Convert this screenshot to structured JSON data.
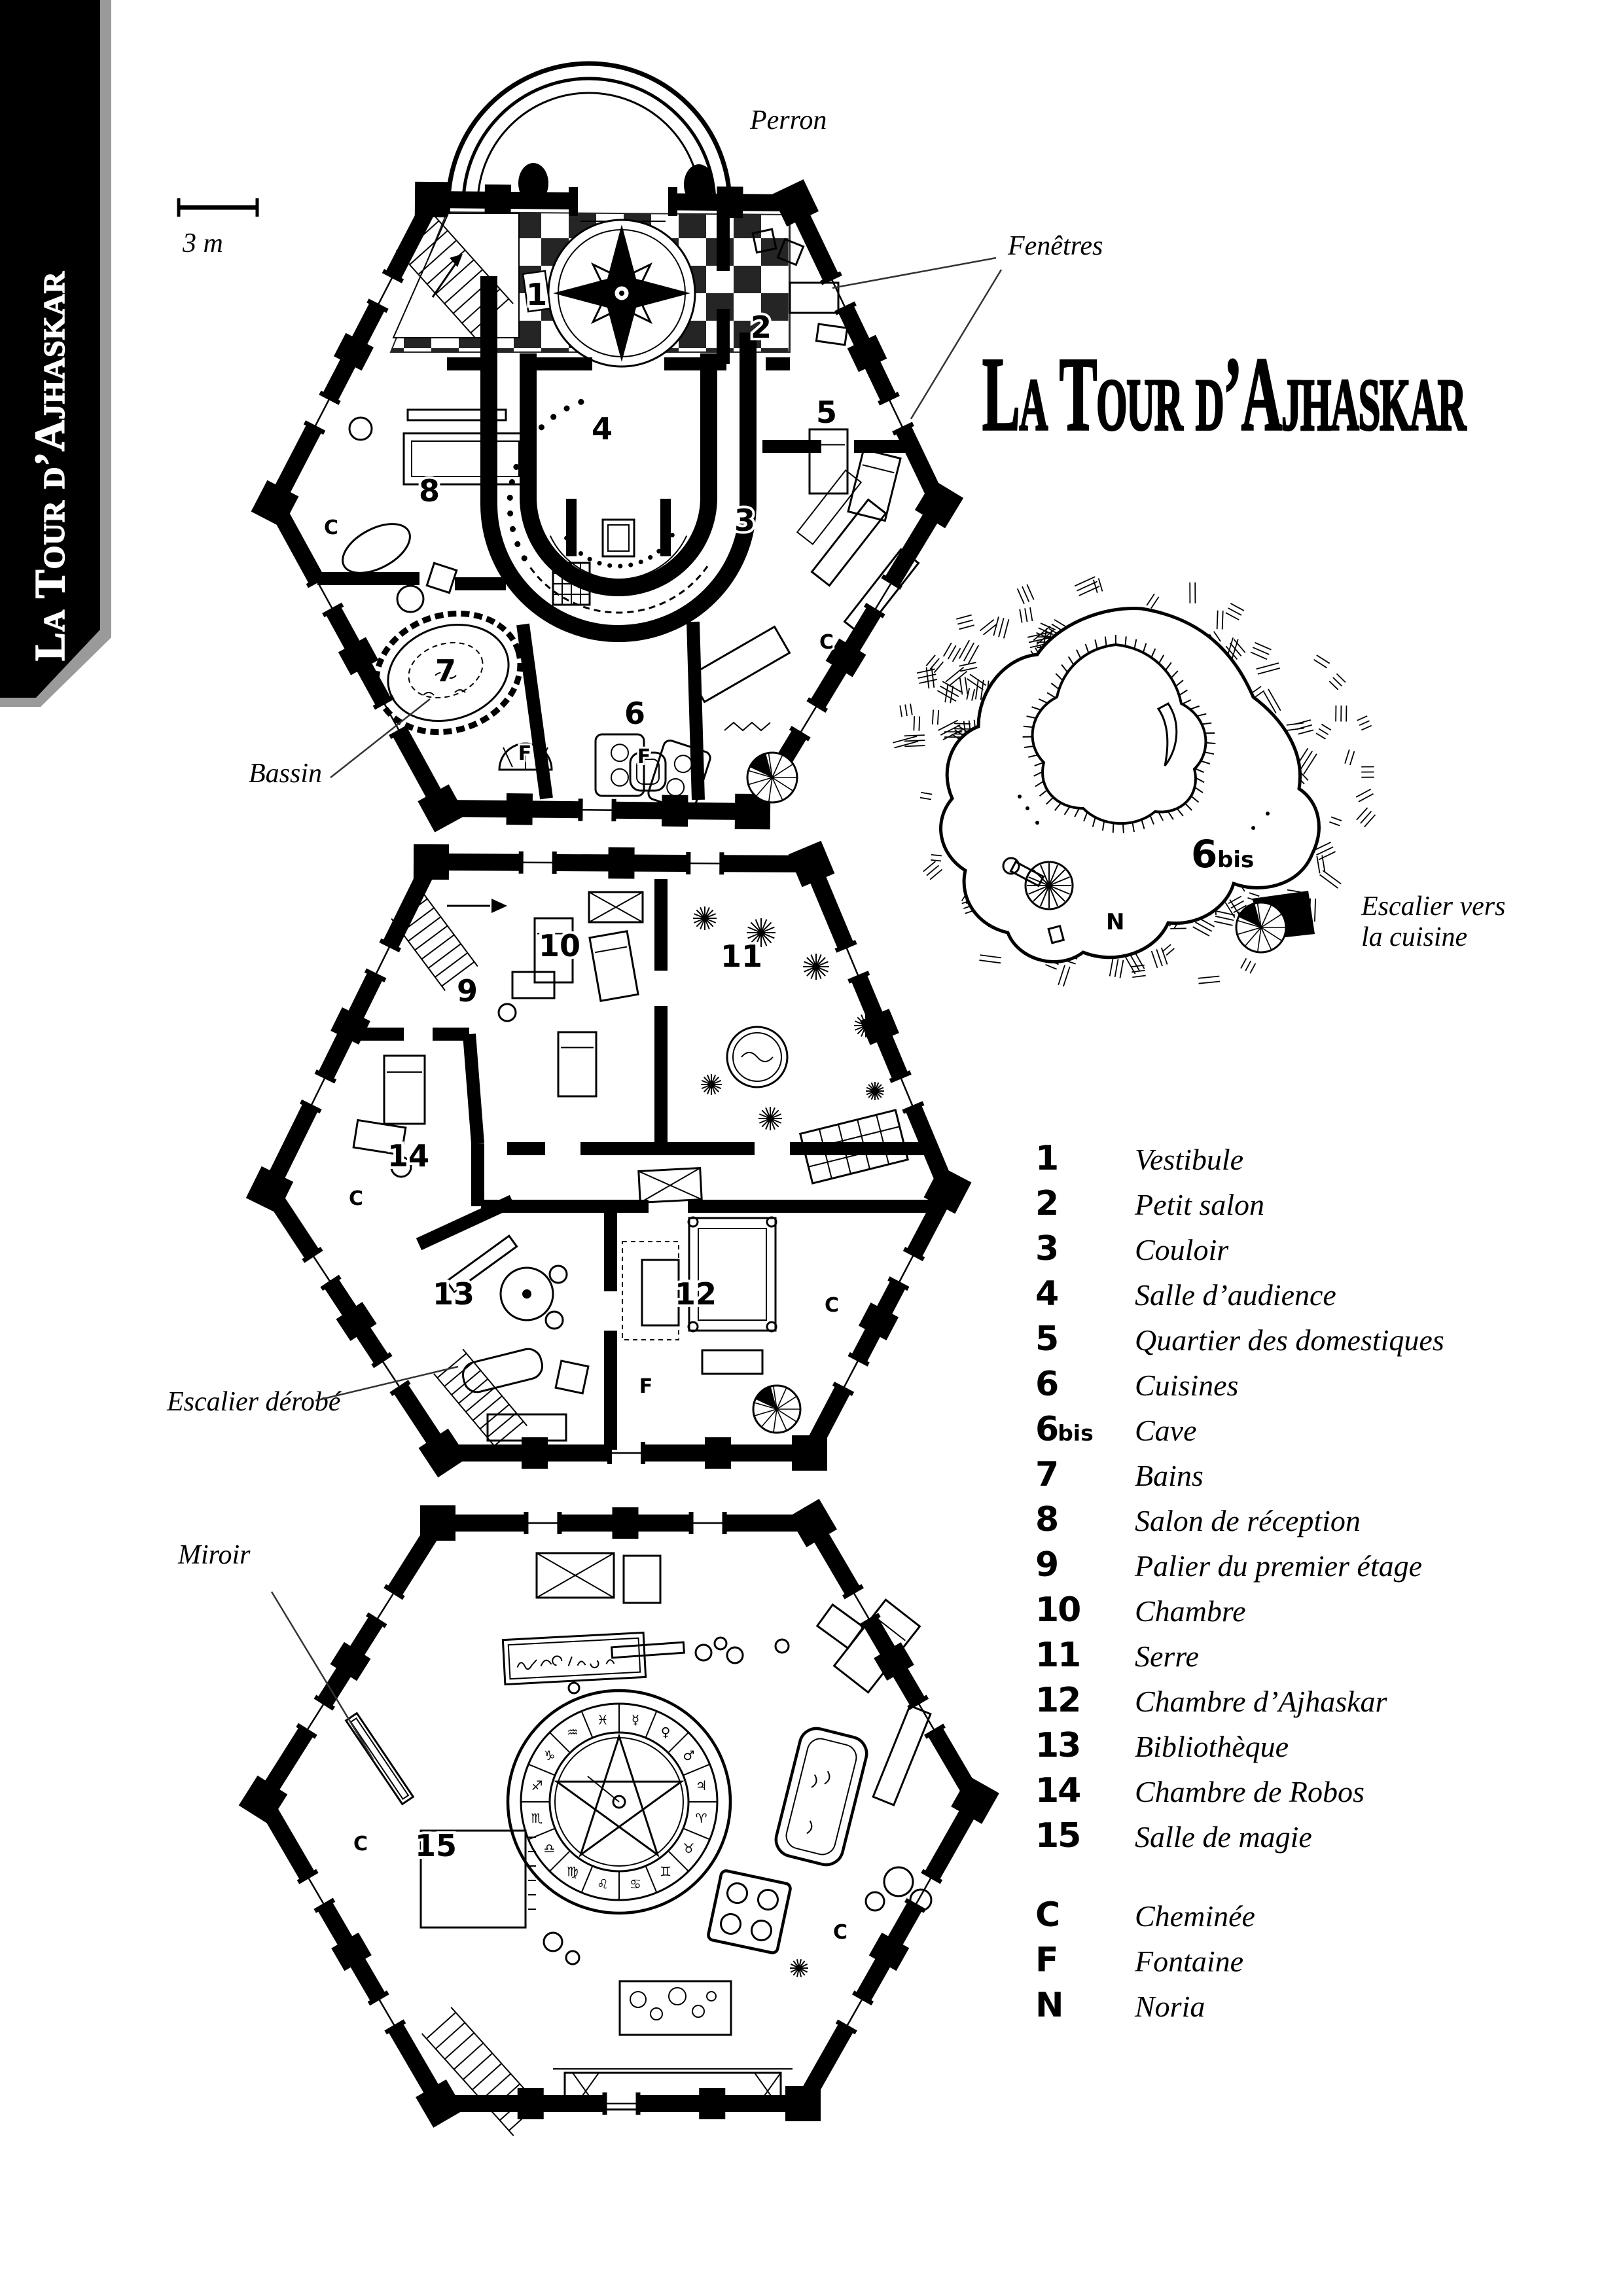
{
  "page": {
    "paper": "#ffffff",
    "ink": "#000000",
    "metal_gray": "#9a9a9a"
  },
  "sidebar": {
    "title": "La Tour d’Ajhaskar"
  },
  "header": {
    "title": "La Tour d’Ajhaskar"
  },
  "scale": {
    "label": "3 m"
  },
  "callouts": {
    "perron": "Perron",
    "fenetres": "Fenêtres",
    "bassin": "Bassin",
    "escalier_cuisine_1": "Escalier vers",
    "escalier_cuisine_2": "la cuisine",
    "escalier_derobe": "Escalier dérobé",
    "miroir": "Miroir"
  },
  "plans": {
    "ground": {
      "numbers": [
        "1",
        "2",
        "3",
        "4",
        "5",
        "6",
        "7",
        "8"
      ],
      "letters": [
        "C",
        "C",
        "F",
        "F"
      ]
    },
    "cave": {
      "number": "6",
      "suffix": "bis",
      "letter": "N"
    },
    "first": {
      "numbers": [
        "9",
        "10",
        "11",
        "12",
        "13",
        "14"
      ],
      "letters": [
        "C",
        "C",
        "F"
      ]
    },
    "second": {
      "numbers": [
        "15"
      ],
      "letters": [
        "C",
        "C"
      ]
    }
  },
  "legend": {
    "items": [
      {
        "num": "1",
        "label": "Vestibule"
      },
      {
        "num": "2",
        "label": "Petit salon"
      },
      {
        "num": "3",
        "label": "Couloir"
      },
      {
        "num": "4",
        "label": "Salle d’audience"
      },
      {
        "num": "5",
        "label": "Quartier des domestiques"
      },
      {
        "num": "6",
        "label": "Cuisines"
      },
      {
        "num": "6",
        "suffix": "bis",
        "label": "Cave"
      },
      {
        "num": "7",
        "label": "Bains"
      },
      {
        "num": "8",
        "label": "Salon de réception"
      },
      {
        "num": "9",
        "label": "Palier du premier étage"
      },
      {
        "num": "10",
        "label": "Chambre"
      },
      {
        "num": "11",
        "label": "Serre"
      },
      {
        "num": "12",
        "label": "Chambre d’Ajhaskar"
      },
      {
        "num": "13",
        "label": "Bibliothèque"
      },
      {
        "num": "14",
        "label": "Chambre de Robos"
      },
      {
        "num": "15",
        "label": "Salle de magie"
      }
    ],
    "letters": [
      {
        "num": "C",
        "label": "Cheminée"
      },
      {
        "num": "F",
        "label": "Fontaine"
      },
      {
        "num": "N",
        "label": "Noria"
      }
    ]
  }
}
